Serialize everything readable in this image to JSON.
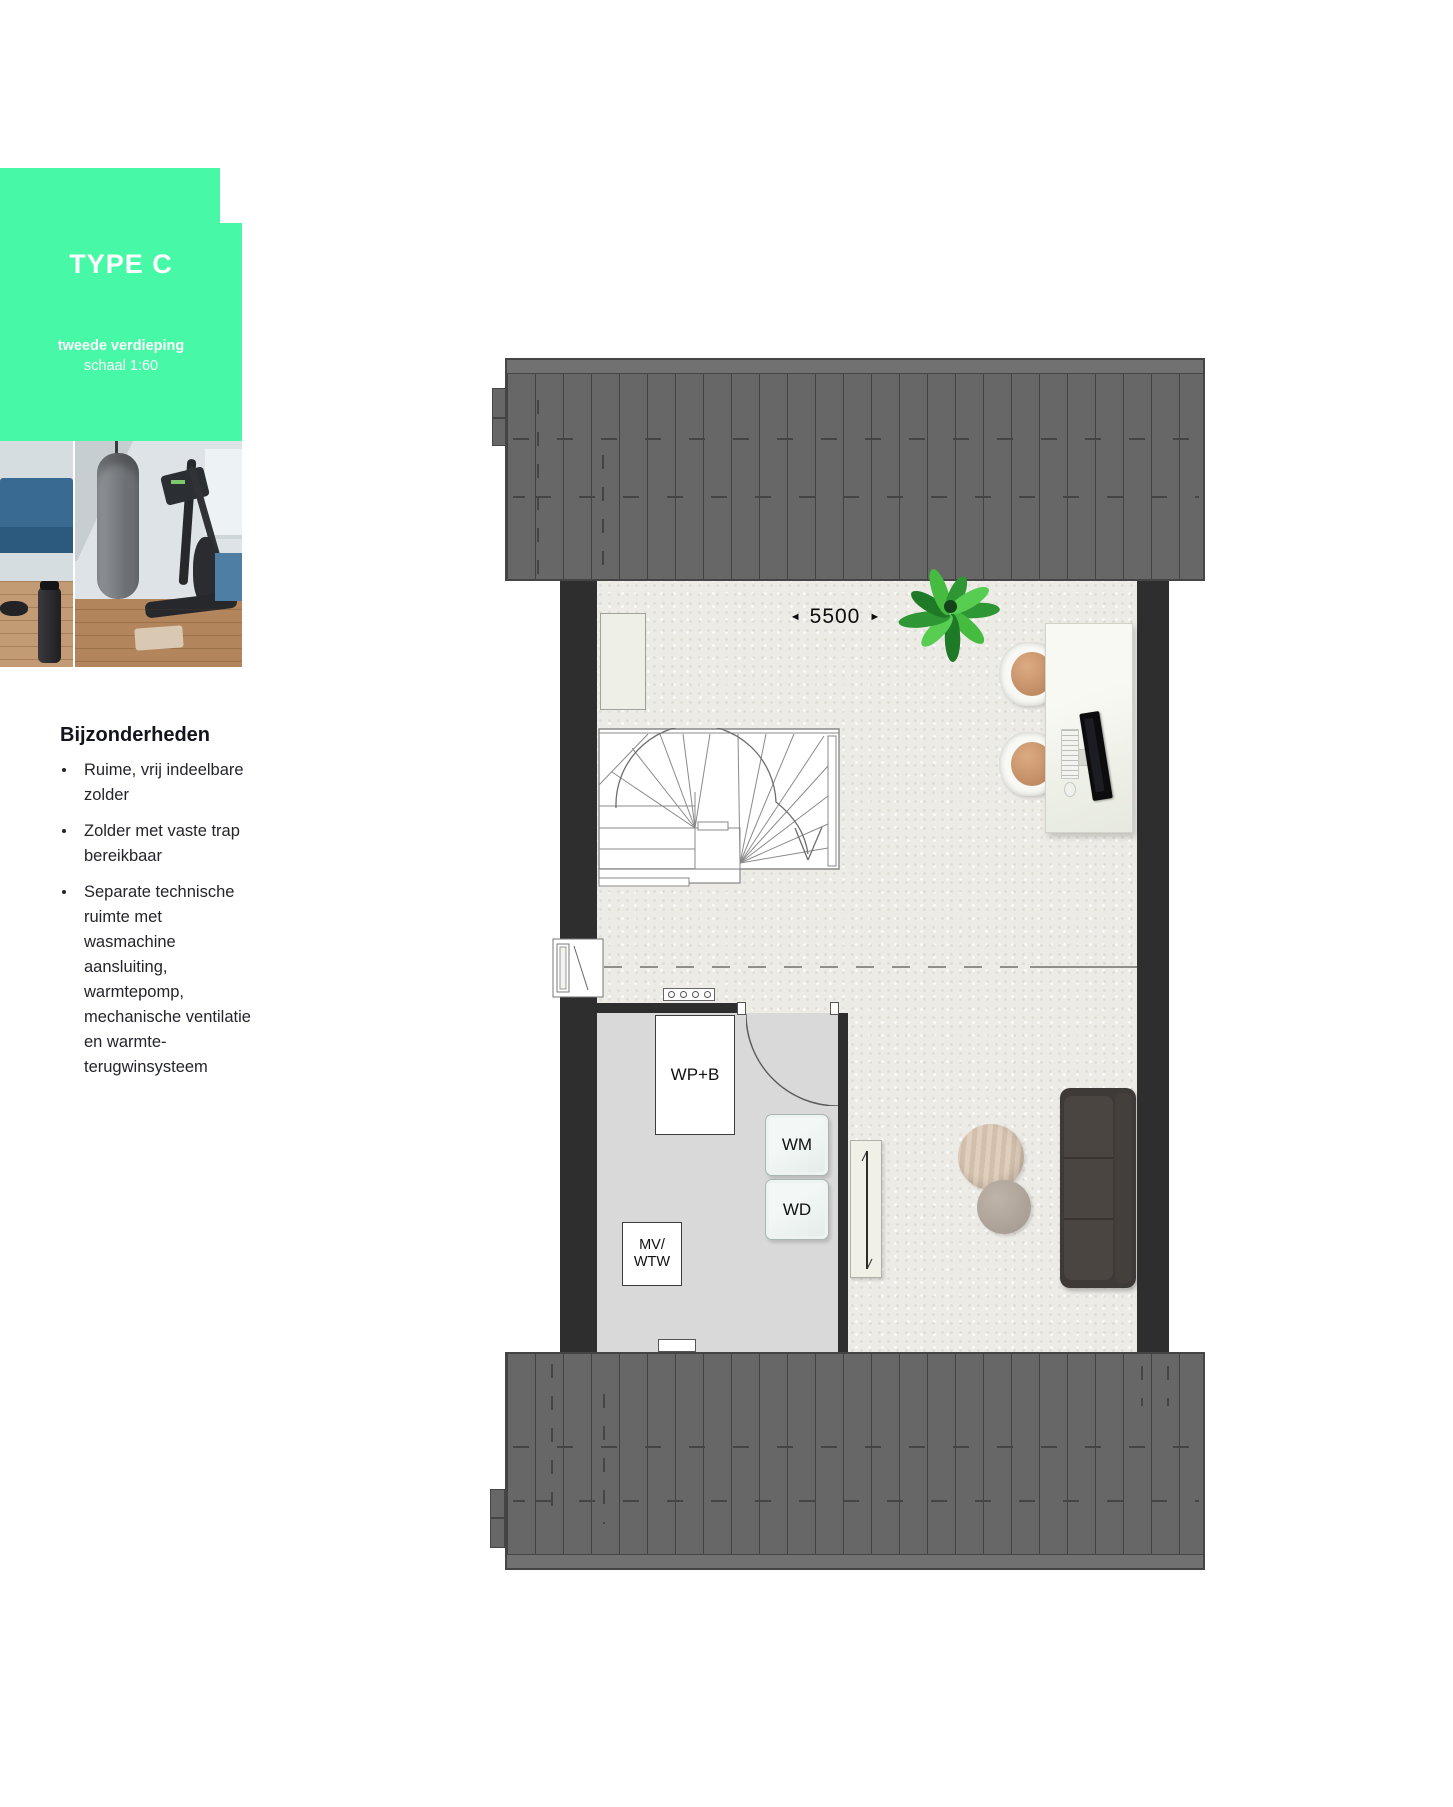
{
  "badge": {
    "title": "TYPE C",
    "floor_label": "tweede verdieping",
    "scale_label": "schaal 1:60",
    "accent_color": "#47f8a6"
  },
  "details": {
    "heading": "Bijzonderheden",
    "bullets": [
      "Ruime, vrij indeelbare zolder",
      "Zolder met vaste trap bereikbaar",
      "Separate technische ruimte met wasmachine aansluiting, warmtepomp, mechanische ventilatie en warmte-terugwinsysteem"
    ]
  },
  "floorplan": {
    "dimension": {
      "arrow_left": "◄",
      "value": "5500",
      "arrow_right": "►"
    },
    "technical_room": {
      "heat_pump_label": "WP+B",
      "washer_label": "WM",
      "dryer_label": "WD",
      "ventilation_line1": "MV/",
      "ventilation_line2": "WTW"
    },
    "colors": {
      "roof": "#676767",
      "wall": "#2e2e2e",
      "carpet": "#edebe6",
      "technical_floor": "#d9d9d9"
    }
  }
}
